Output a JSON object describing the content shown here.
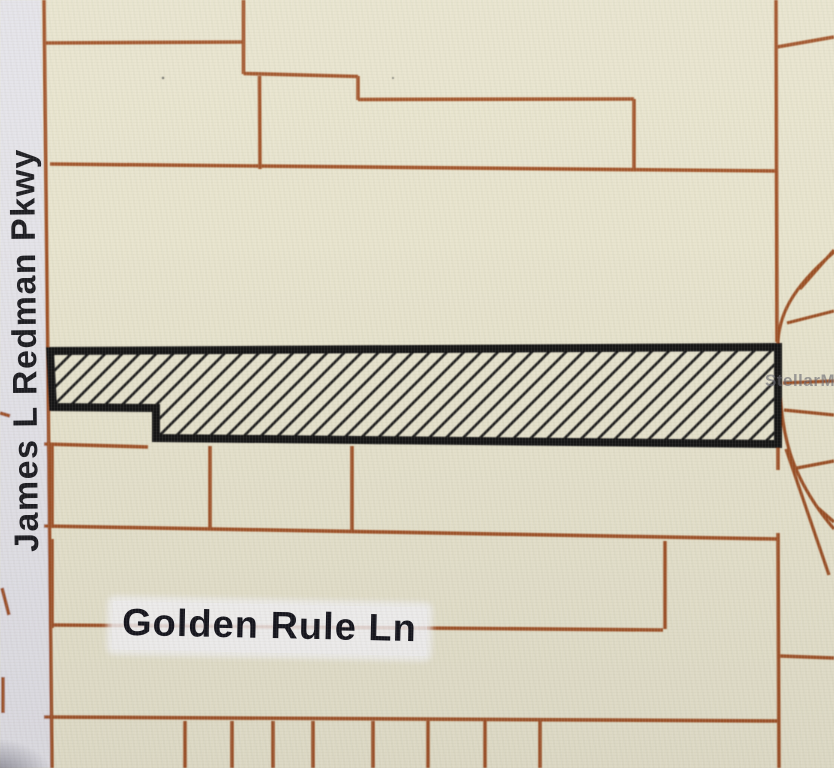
{
  "map": {
    "road_labels": [
      {
        "id": "james-l-redman-pkwy",
        "text": "James L Redman Pkwy"
      },
      {
        "id": "golden-rule-ln",
        "text": "Golden Rule Ln"
      }
    ],
    "watermark": "StellarMLS",
    "colors": {
      "map_background": "#e8e4ce",
      "road_fill": "#e4e3e9",
      "parcel_line": "#a2552c",
      "parcel_line_dark": "#9d5126",
      "highlight_outline": "#171717",
      "label_text": "#15151d",
      "watermark_text": "#696972"
    }
  }
}
